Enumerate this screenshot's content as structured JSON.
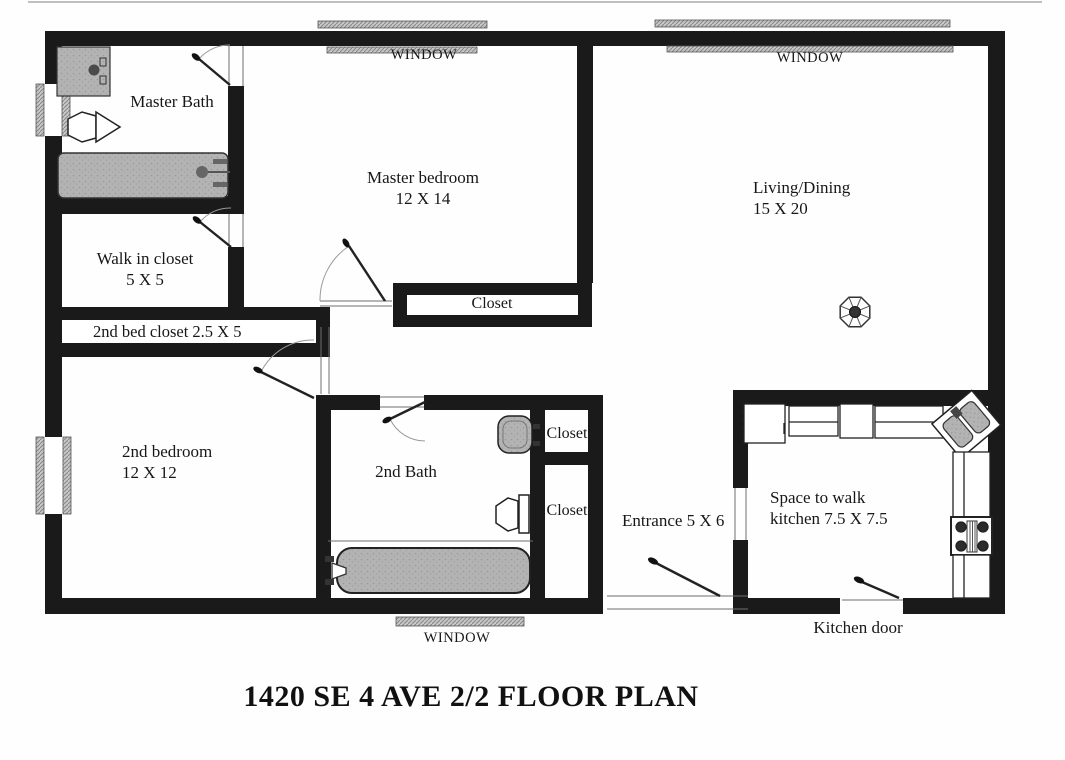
{
  "title": "1420 SE 4 AVE 2/2 FLOOR PLAN",
  "windows": {
    "top_left": "WINDOW",
    "top_right": "WINDOW",
    "bottom": "WINDOW"
  },
  "rooms": {
    "master_bath": {
      "name": "Master Bath"
    },
    "master_bedroom": {
      "name": "Master bedroom",
      "dims": "12 X 14"
    },
    "living_dining": {
      "name": "Living/Dining",
      "dims": "15 X 20"
    },
    "walk_in_closet": {
      "name": "Walk in closet",
      "dims": "5 X 5"
    },
    "second_bed_closet": {
      "name": "2nd bed closet 2.5 X 5"
    },
    "second_bedroom": {
      "name": "2nd bedroom",
      "dims": "12 X 12"
    },
    "second_bath": {
      "name": "2nd Bath"
    },
    "master_closet": {
      "name": "Closet"
    },
    "hall_closet_upper": {
      "name": "Closet"
    },
    "hall_closet_lower": {
      "name": "Closet"
    },
    "entrance": {
      "name": "Entrance 5 X 6"
    },
    "kitchen": {
      "name": "Space to walk",
      "dims": "kitchen 7.5 X 7.5"
    },
    "kitchen_door": {
      "name": "Kitchen door"
    }
  },
  "colors": {
    "wall": "#1a1a1a",
    "fixture_gray": "#b3b3b3",
    "thin_line": "#6e6e6e",
    "background": "#fefefe"
  }
}
